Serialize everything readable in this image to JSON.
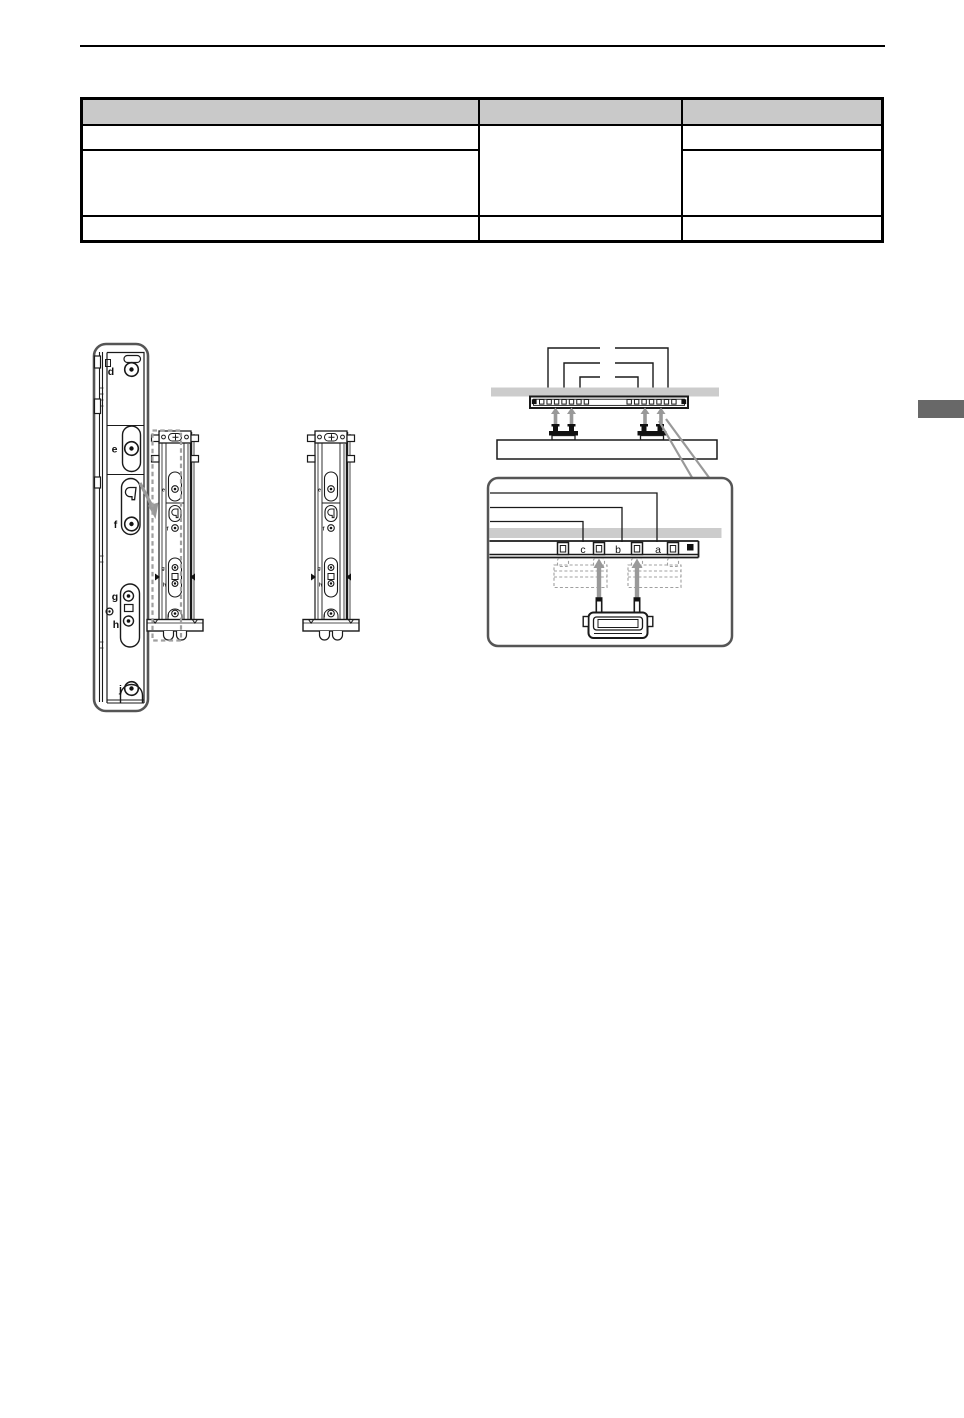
{
  "table": {
    "header": [
      "",
      "",
      ""
    ],
    "rows": [
      [
        "",
        "",
        ""
      ],
      [
        "",
        ""
      ],
      [
        "",
        "",
        ""
      ]
    ]
  },
  "labels": {
    "d": "d",
    "e": "e",
    "f": "f",
    "g": "g",
    "h": "h",
    "j": "j",
    "c": "c",
    "b": "b",
    "a": "a"
  },
  "mini_labels": {
    "e": "e",
    "f": "f",
    "g": "g",
    "h": "h",
    "j": "j"
  },
  "colors": {
    "table_header_bg": "#c9c9c9",
    "shade_band": "#cccccc",
    "pointer_gray": "#999999",
    "edge_tab": "#686868",
    "line": "#1a1a1a"
  }
}
